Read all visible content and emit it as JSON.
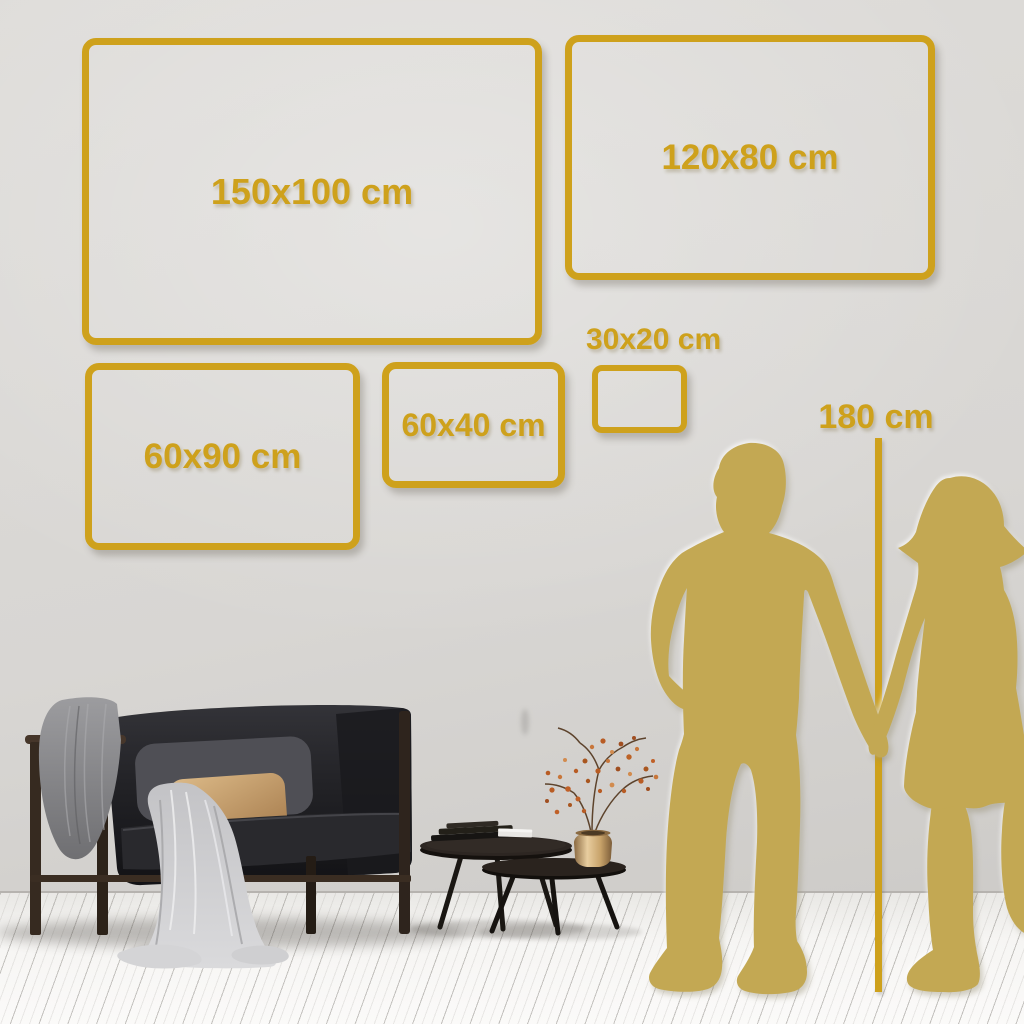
{
  "frames": [
    {
      "id": "150x100",
      "label": "150x100 cm"
    },
    {
      "id": "120x80",
      "label": "120x80 cm"
    },
    {
      "id": "60x90",
      "label": "60x90 cm"
    },
    {
      "id": "60x40",
      "label": "60x40 cm"
    },
    {
      "id": "30x20",
      "label": "30x20 cm"
    }
  ],
  "height_reference": {
    "label": "180 cm"
  },
  "colors": {
    "gold": "#cea11c",
    "silhouette-gold": "#c3a853",
    "wall": "#d8d6d3",
    "floor": "#f6f5f3"
  }
}
